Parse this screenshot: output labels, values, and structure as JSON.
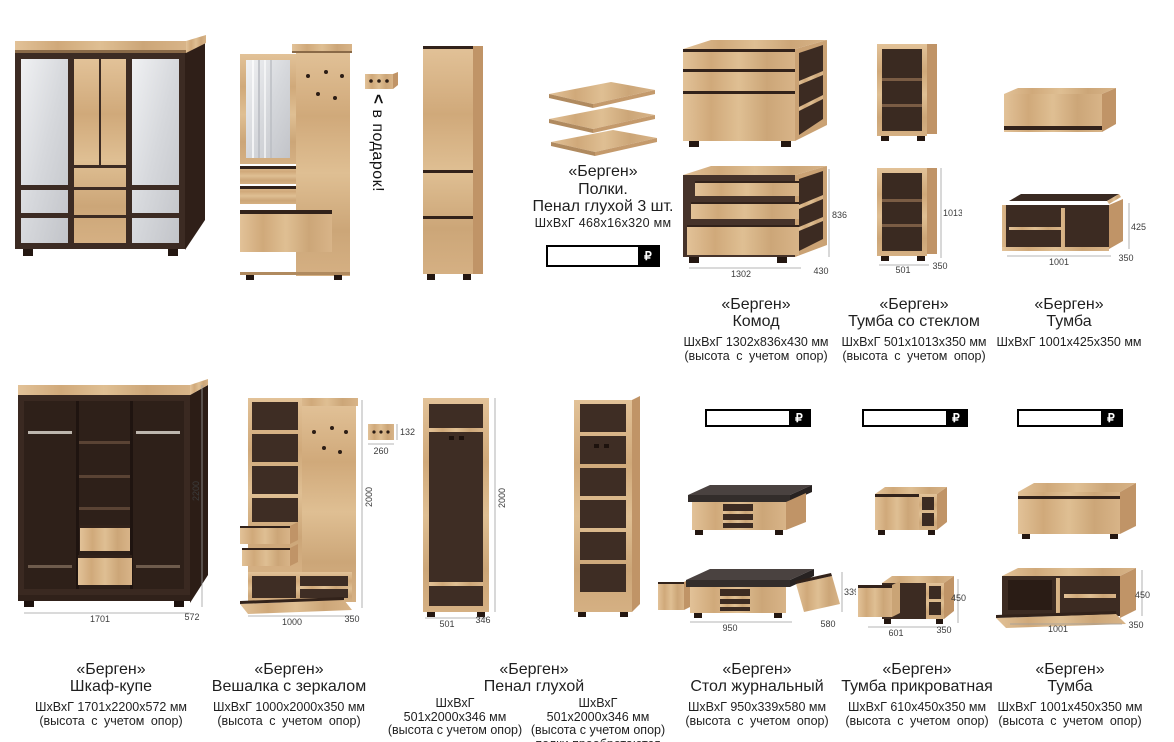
{
  "currency": "₽",
  "gift": {
    "arrow": "<",
    "text": "в подарок!"
  },
  "shelves_info": {
    "title": "«Берген»",
    "line2": "Полки.",
    "line3": "Пенал глухой 3 шт.",
    "dims": "ШхВхГ  468х16х320  мм"
  },
  "captions_top": [
    {
      "title": "«Берген»",
      "name": "Комод",
      "dims": "ШхВхГ 1302х836х430 мм",
      "note": "(высота с учетом опор)"
    },
    {
      "title": "«Берген»",
      "name": "Тумба со стеклом",
      "dims": "ШхВхГ 501х1013х350 мм",
      "note": "(высота с учетом опор)"
    },
    {
      "title": "«Берген»",
      "name": "Тумба",
      "dims": "ШхВхГ 1001х425х350 мм",
      "note": ""
    }
  ],
  "captions_bottom": [
    {
      "title": "«Берген»",
      "name": "Шкаф-купе",
      "dims": "ШхВхГ 1701х2200х572 мм",
      "note": "(высота с учетом опор)"
    },
    {
      "title": "«Берген»",
      "name": "Вешалка с зеркалом",
      "dims": "ШхВхГ 1000х2000х350 мм",
      "note": "(высота с учетом опор)"
    },
    {
      "title": "«Берген»",
      "name": "Стол журнальный",
      "dims": "ШхВхГ 950х339х580 мм",
      "note": "(высота с учетом опор)"
    },
    {
      "title": "«Берген»",
      "name": "Тумба прикроватная",
      "dims": "ШхВхГ 610х450х350 мм",
      "note": "(высота с учетом опор)"
    },
    {
      "title": "«Берген»",
      "name": "Тумба",
      "dims": "ШхВхГ 1001х450х350 мм",
      "note": "(высота с учетом опор)"
    }
  ],
  "penal_caption": {
    "title": "«Берген»",
    "name": "Пенал глухой",
    "left": {
      "l1": "ШхВхГ",
      "l2": "501х2000х346 мм",
      "l3": "(высота с учетом опор)"
    },
    "right": {
      "l1": "ШхВхГ",
      "l2": "501х2000х346 мм",
      "l3": "(высота с учетом опор)",
      "l4": "полки преобретаются"
    }
  },
  "dims": {
    "komod": {
      "w": "1302",
      "h": "836",
      "d": "430"
    },
    "tumba_steklo": {
      "w": "501",
      "h": "1013",
      "d": "350"
    },
    "tumba_wall": {
      "w": "1001",
      "h": "425",
      "d": "350"
    },
    "shkaf": {
      "w": "1701",
      "h": "2200",
      "d": "572"
    },
    "veshalka": {
      "w": "1000",
      "h": "2000",
      "d": "350"
    },
    "hooks": {
      "w": "260",
      "h": "132"
    },
    "penal": {
      "w": "501",
      "h": "2000",
      "d": "346"
    },
    "stol": {
      "w": "950",
      "h": "339",
      "d": "580"
    },
    "tumba_prikr": {
      "w": "601",
      "h": "450",
      "d": "350"
    },
    "tumba_big": {
      "w": "1001",
      "h": "450",
      "d": "350"
    }
  },
  "colors": {
    "wood": "#d8b488",
    "dark_frame": "#402e26",
    "price_border": "#000000"
  }
}
